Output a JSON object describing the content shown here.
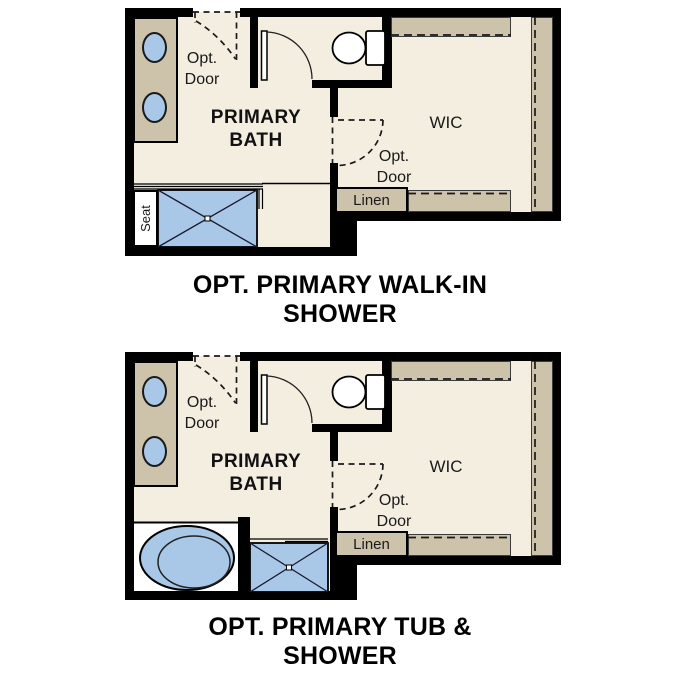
{
  "colors": {
    "wall": "#000000",
    "floor": "#f4eee1",
    "cabinet": "#cdc3aa",
    "fixture": "#a9c8e8",
    "outline": "#1a1a1a",
    "text": "#1a1a1a",
    "title": "#000000"
  },
  "plans": [
    {
      "name": "opt-primary-walk-in-shower",
      "title_line1": "OPT. PRIMARY WALK-IN",
      "title_line2": "SHOWER",
      "labels": {
        "opt_door_top_1": "Opt.",
        "opt_door_top_2": "Door",
        "room_1": "PRIMARY",
        "room_2": "BATH",
        "wic": "WIC",
        "opt_door_wic_1": "Opt.",
        "opt_door_wic_2": "Door",
        "linen": "Linen",
        "seat": "Seat"
      }
    },
    {
      "name": "opt-primary-tub-and-shower",
      "title_line1": "OPT. PRIMARY TUB &",
      "title_line2": "SHOWER",
      "labels": {
        "opt_door_top_1": "Opt.",
        "opt_door_top_2": "Door",
        "room_1": "PRIMARY",
        "room_2": "BATH",
        "wic": "WIC",
        "opt_door_wic_1": "Opt.",
        "opt_door_wic_2": "Door",
        "linen": "Linen"
      }
    }
  ]
}
